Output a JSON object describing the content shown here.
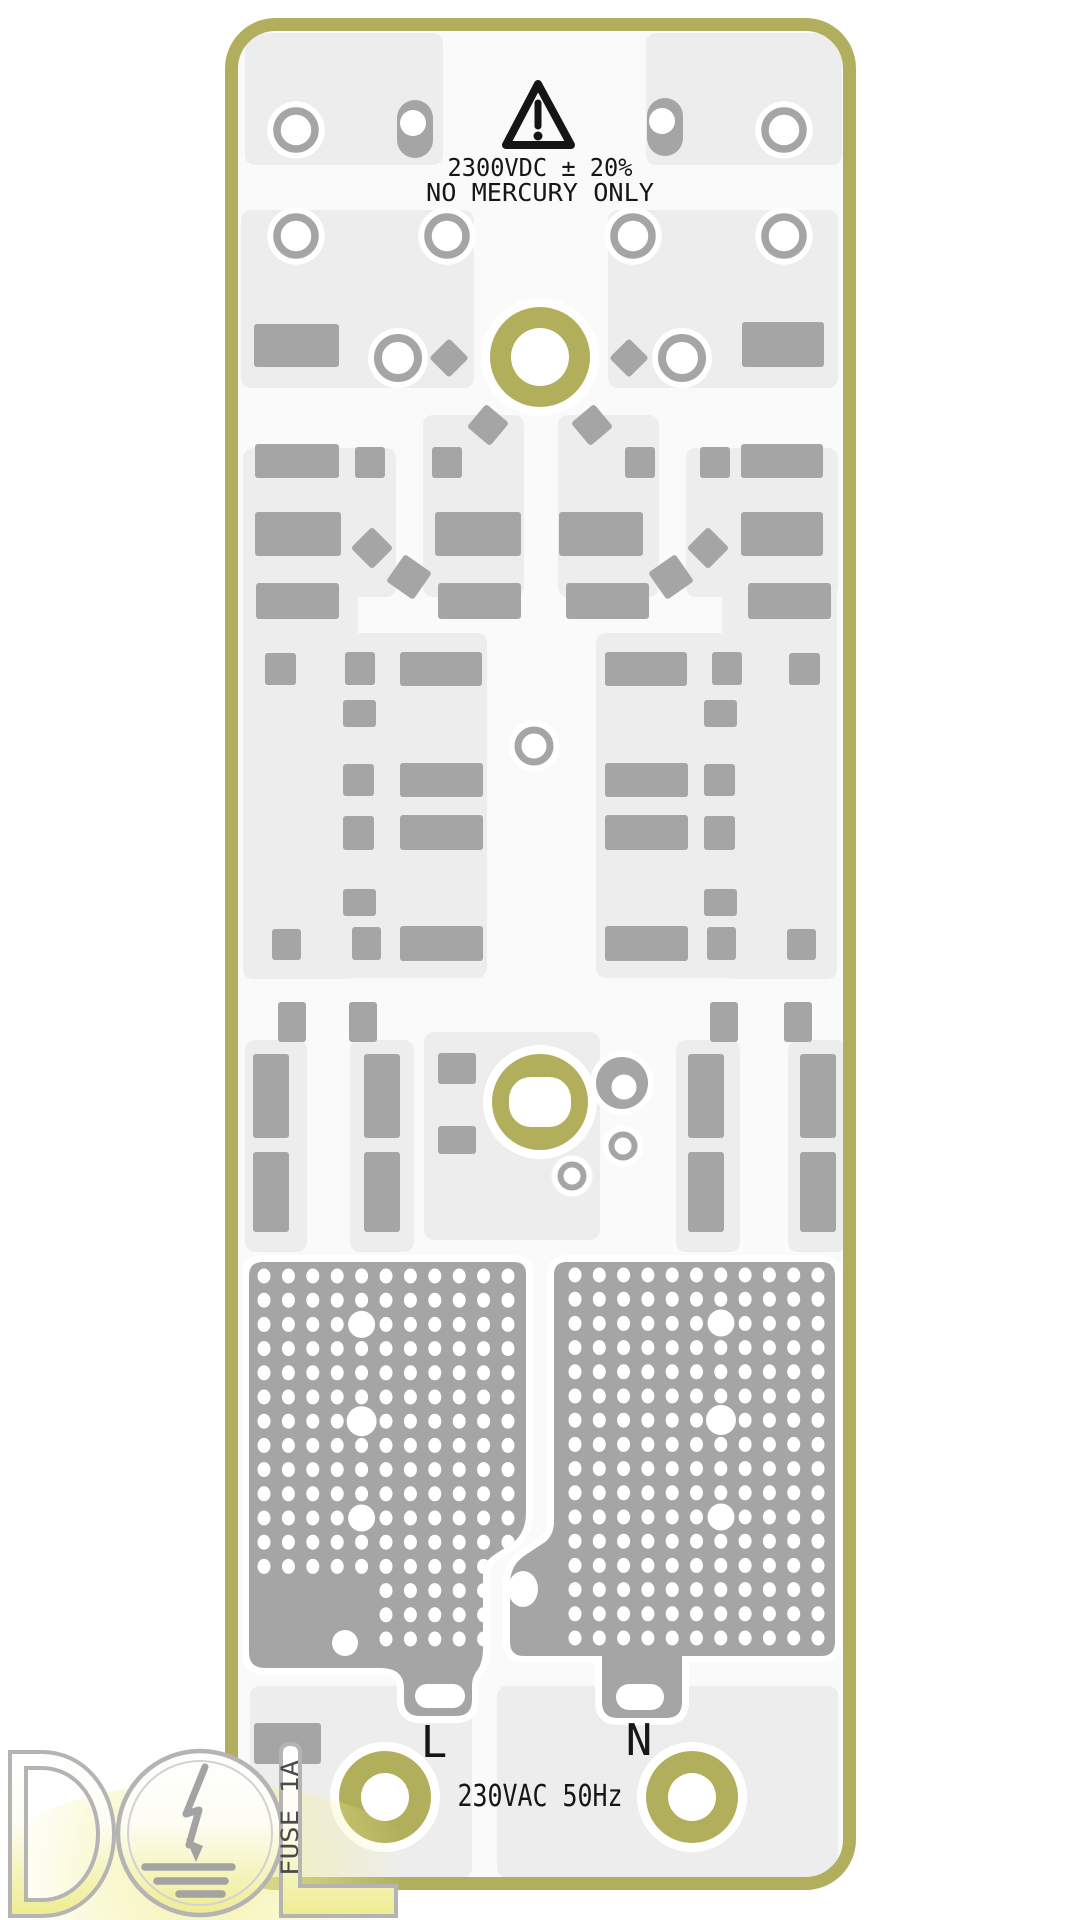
{
  "labels": {
    "warning_line1": "2300VDC ± 20%",
    "warning_line2": "NO MERCURY ONLY",
    "live": "L",
    "neutral": "N",
    "mains_rating": "230VAC 50Hz",
    "fuse_rating": "FUSE 1A"
  },
  "colors": {
    "page_bg": "#ffffff",
    "board_bg": "#fafafa",
    "board_border": "#b1ae5d",
    "panel": "#ededed",
    "pad": "#a5a5a5",
    "hole_ring": "#b2af5c",
    "silkscreen": "#151515",
    "fuse_text": "#4a4a4a",
    "logo_outline": "#b4b4b4",
    "logo_symbol": "#a3a3a3",
    "logo_yellow": "#f3f1a0"
  },
  "board": {
    "x": 225,
    "y": 18,
    "w": 631,
    "h": 1872,
    "rx": 44,
    "border_w": 13
  },
  "panels": [
    [
      245,
      33,
      198,
      132
    ],
    [
      646,
      33,
      196,
      132
    ],
    [
      241,
      210,
      233,
      178
    ],
    [
      608,
      210,
      230,
      178
    ],
    [
      243,
      448,
      153,
      149
    ],
    [
      686,
      448,
      152,
      149
    ],
    [
      423,
      415,
      101,
      182
    ],
    [
      558,
      415,
      101,
      182
    ],
    [
      243,
      555,
      115,
      424
    ],
    [
      722,
      555,
      115,
      424
    ],
    [
      342,
      633,
      145,
      345
    ],
    [
      596,
      633,
      145,
      345
    ],
    [
      424,
      1032,
      176,
      208
    ],
    [
      245,
      1040,
      62,
      212
    ],
    [
      350,
      1040,
      64,
      212
    ],
    [
      676,
      1040,
      64,
      212
    ],
    [
      788,
      1040,
      58,
      212
    ],
    [
      250,
      1686,
      222,
      192
    ],
    [
      497,
      1686,
      341,
      192
    ]
  ],
  "pads": {
    "rects": [
      [
        254,
        324,
        85,
        43
      ],
      [
        742,
        322,
        82,
        45
      ],
      [
        255,
        444,
        84,
        34
      ],
      [
        741,
        444,
        82,
        34
      ],
      [
        355,
        447,
        30,
        31
      ],
      [
        432,
        447,
        30,
        31
      ],
      [
        625,
        447,
        30,
        31
      ],
      [
        700,
        447,
        30,
        31
      ],
      [
        255,
        512,
        86,
        44
      ],
      [
        435,
        512,
        86,
        44
      ],
      [
        559,
        512,
        84,
        44
      ],
      [
        741,
        512,
        82,
        44
      ],
      [
        256,
        583,
        83,
        36
      ],
      [
        438,
        583,
        83,
        36
      ],
      [
        566,
        583,
        83,
        36
      ],
      [
        748,
        583,
        83,
        36
      ],
      [
        265,
        653,
        31,
        32
      ],
      [
        345,
        652,
        30,
        33
      ],
      [
        400,
        652,
        82,
        34
      ],
      [
        605,
        652,
        82,
        34
      ],
      [
        712,
        652,
        30,
        33
      ],
      [
        789,
        653,
        31,
        32
      ],
      [
        343,
        700,
        33,
        27
      ],
      [
        704,
        700,
        33,
        27
      ],
      [
        343,
        764,
        31,
        32
      ],
      [
        400,
        763,
        83,
        34
      ],
      [
        605,
        763,
        83,
        34
      ],
      [
        704,
        764,
        31,
        32
      ],
      [
        343,
        816,
        31,
        34
      ],
      [
        400,
        815,
        83,
        35
      ],
      [
        605,
        815,
        83,
        35
      ],
      [
        704,
        816,
        31,
        34
      ],
      [
        343,
        889,
        33,
        27
      ],
      [
        704,
        889,
        33,
        27
      ],
      [
        272,
        929,
        29,
        31
      ],
      [
        352,
        927,
        29,
        33
      ],
      [
        400,
        926,
        83,
        35
      ],
      [
        605,
        926,
        83,
        35
      ],
      [
        707,
        927,
        29,
        33
      ],
      [
        787,
        929,
        29,
        31
      ],
      [
        278,
        1002,
        28,
        40
      ],
      [
        349,
        1002,
        28,
        40
      ],
      [
        710,
        1002,
        28,
        40
      ],
      [
        784,
        1002,
        28,
        40
      ],
      [
        253,
        1054,
        36,
        84
      ],
      [
        364,
        1054,
        36,
        84
      ],
      [
        688,
        1054,
        36,
        84
      ],
      [
        800,
        1054,
        36,
        84
      ],
      [
        253,
        1152,
        36,
        80
      ],
      [
        364,
        1152,
        36,
        80
      ],
      [
        688,
        1152,
        36,
        80
      ],
      [
        800,
        1152,
        36,
        80
      ],
      [
        438,
        1053,
        38,
        31
      ],
      [
        438,
        1126,
        38,
        28
      ],
      [
        254,
        1723,
        67,
        41
      ]
    ],
    "diamonds": [
      [
        449,
        358,
        28,
        45
      ],
      [
        629,
        358,
        28,
        45
      ],
      [
        488,
        425,
        30,
        40
      ],
      [
        592,
        425,
        30,
        -40
      ],
      [
        372,
        548,
        30,
        45
      ],
      [
        708,
        548,
        30,
        45
      ],
      [
        409,
        577,
        33,
        35
      ],
      [
        671,
        577,
        33,
        -35
      ]
    ],
    "rings": [
      [
        296,
        130,
        19,
        7.5
      ],
      [
        784,
        130,
        19,
        7.5
      ],
      [
        296,
        236,
        19,
        7.5
      ],
      [
        447,
        236,
        19,
        7.5
      ],
      [
        633,
        236,
        19,
        7.5
      ],
      [
        784,
        236,
        19,
        7.5
      ],
      [
        398,
        358,
        20,
        8
      ],
      [
        682,
        358,
        20,
        8
      ],
      [
        534,
        746,
        16,
        7
      ],
      [
        623,
        1146,
        11.5,
        6
      ],
      [
        572,
        1176,
        11.5,
        6
      ]
    ],
    "donuts": [
      [
        622,
        1083,
        26,
        12.5
      ]
    ],
    "stadiums": [
      [
        397,
        100,
        36,
        58,
        18,
        413,
        123,
        13
      ],
      [
        647,
        98,
        36,
        58,
        18,
        662,
        121,
        13
      ]
    ]
  },
  "holes": [
    {
      "cx": 540,
      "cy": 357,
      "ro": 50,
      "ri": 29
    },
    {
      "cx": 540,
      "cy": 1102,
      "ro": 48,
      "rrect": [
        509,
        1077,
        62,
        50,
        22
      ]
    },
    {
      "cx": 385,
      "cy": 1797,
      "ro": 46,
      "ri": 24
    },
    {
      "cx": 692,
      "cy": 1797,
      "ro": 46,
      "ri": 24
    }
  ],
  "pours": {
    "left": {
      "path": "M 263 1262 H 514 Q 526 1262 526 1274 V 1512 Q 526 1534 511 1544 L 494 1555 Q 483 1562 483 1576 V 1648 Q 483 1664 476 1672 Q 472 1678 472 1686 V 1700 Q 472 1716 456 1716 H 420 Q 404 1716 404 1700 V 1688 Q 404 1676 395 1671 Q 389 1668 380 1668 H 265 Q 249 1668 249 1652 V 1276 Q 249 1262 263 1262 Z",
      "grid": {
        "x0": 264,
        "y0": 1276,
        "dx": 24.4,
        "dy": 24.2,
        "nx": 11,
        "ny": 16
      },
      "vias": [
        [
          361.6,
          1324.4,
          13.5
        ],
        [
          361.6,
          1421.2,
          15
        ],
        [
          361.6,
          1518,
          13.5
        ],
        [
          345,
          1643,
          13
        ]
      ],
      "skip": [
        [
          238,
          1576,
          134,
          110
        ]
      ],
      "white_stadiums": [
        [
          415,
          1684,
          50,
          24,
          12
        ]
      ],
      "white_ellipses": []
    },
    "right": {
      "path": "M 567 1262 H 821 Q 835 1262 835 1276 V 1642 Q 835 1656 821 1656 H 682 V 1702 Q 682 1718 666 1718 H 618 Q 602 1718 602 1702 V 1656 H 524 Q 510 1656 510 1642 V 1584 Q 510 1566 524 1556 L 545 1542 Q 554 1535 554 1521 V 1275 Q 554 1262 567 1262 Z",
      "grid": {
        "x0": 575,
        "y0": 1275,
        "dx": 24.3,
        "dy": 24.2,
        "nx": 11,
        "ny": 16
      },
      "vias": [
        [
          721,
          1323,
          13.5
        ],
        [
          721,
          1420,
          15
        ],
        [
          721,
          1517,
          13.5
        ]
      ],
      "skip": [],
      "white_stadiums": [
        [
          616,
          1684,
          48,
          26,
          13
        ]
      ],
      "white_ellipses": [
        [
          523,
          1589,
          15,
          18
        ]
      ]
    }
  }
}
